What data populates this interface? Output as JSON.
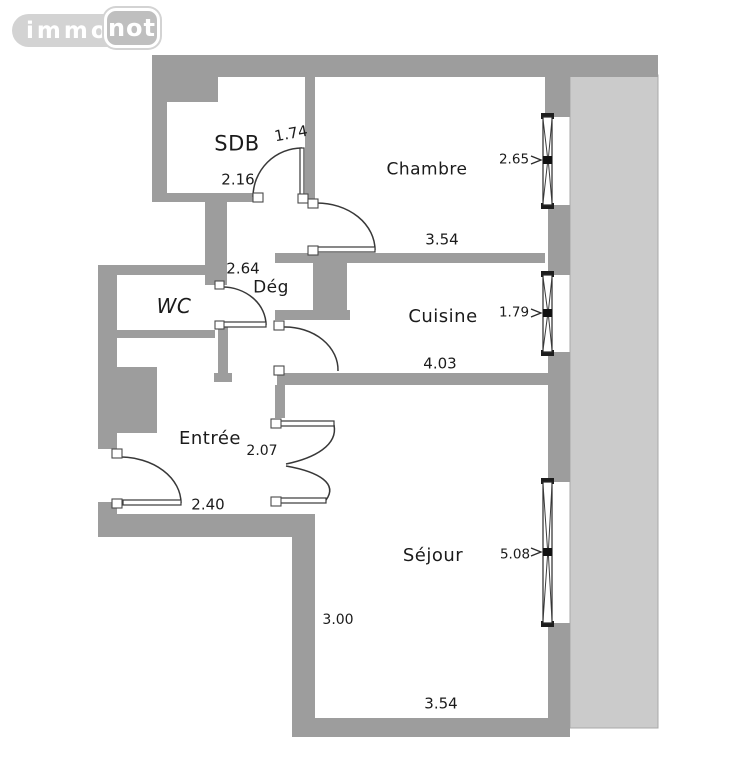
{
  "logo": {
    "brand_left": "immo",
    "brand_right": "not"
  },
  "colors": {
    "wall": "#9d9d9d",
    "terrace": "#cbcbcb",
    "line": "#383838",
    "text": "#1b1b1b",
    "logo-pill": "#d3d3d3",
    "logo-block": "#bfbfbf"
  },
  "plan": {
    "type": "apartment-floor-plan",
    "rooms": [
      {
        "key": "sdb",
        "label": "SDB"
      },
      {
        "key": "chambre",
        "label": "Chambre"
      },
      {
        "key": "wc",
        "label": "WC"
      },
      {
        "key": "deg",
        "label": "Dég"
      },
      {
        "key": "cuisine",
        "label": "Cuisine"
      },
      {
        "key": "entree",
        "label": "Entrée"
      },
      {
        "key": "sejour",
        "label": "Séjour"
      }
    ],
    "dimensions": [
      {
        "key": "sdb-door-width",
        "value": "1.74"
      },
      {
        "key": "sdb-width",
        "value": "2.16"
      },
      {
        "key": "chambre-window-width",
        "value": "2.65"
      },
      {
        "key": "chambre-width",
        "value": "3.54"
      },
      {
        "key": "deg-length",
        "value": "2.64"
      },
      {
        "key": "cuisine-window-width",
        "value": "1.79"
      },
      {
        "key": "cuisine-width",
        "value": "4.03"
      },
      {
        "key": "entree-door-width",
        "value": "2.07"
      },
      {
        "key": "entree-width",
        "value": "2.40"
      },
      {
        "key": "sejour-window-width",
        "value": "5.08"
      },
      {
        "key": "sejour-depth",
        "value": "3.00"
      },
      {
        "key": "sejour-width",
        "value": "3.54"
      }
    ]
  }
}
